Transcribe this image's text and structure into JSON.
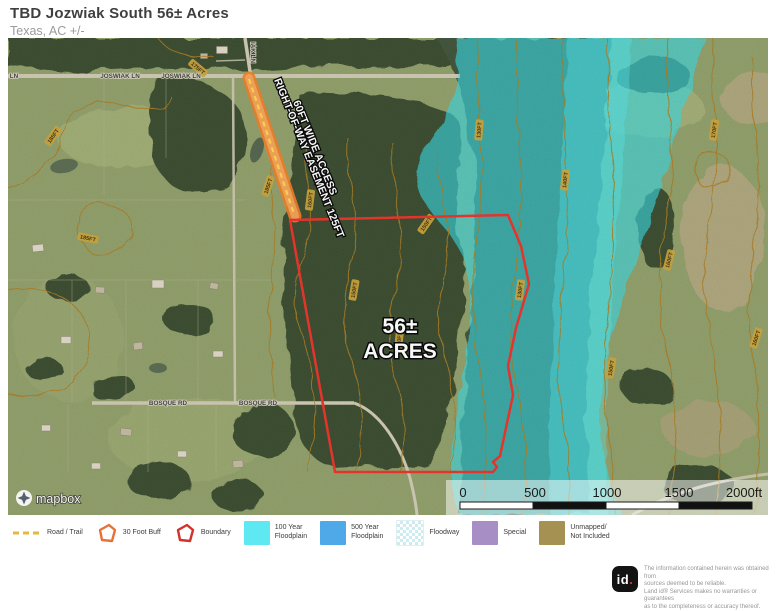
{
  "header": {
    "title": "TBD Jozwiak South 56± Acres",
    "subtitle": "Texas,  AC +/-"
  },
  "map": {
    "acres_line1": "56±",
    "acres_line2": "ACRES",
    "easement_line1": "60FT WIDE ACCESS",
    "easement_line2": "RIGHT-OF-WAY EASEMENT 125FT",
    "streets": {
      "joswiak1": "JOSWIAK LN",
      "joswiak2": "JOSWIAK LN",
      "ln_partial": "LN",
      "vertical": "IAK LN",
      "bosque1": "BOSQUE RD",
      "bosque2": "BOSQUE RD"
    },
    "contour_labels": [
      "185FT",
      "185FT",
      "175FT",
      "160FT",
      "150FT",
      "140FT",
      "150FT",
      "130FT",
      "130FT",
      "140FT",
      "150FT",
      "160FT",
      "170FT",
      "160FT",
      "185FT"
    ],
    "scale": {
      "t0": "0",
      "t500": "500",
      "t1000": "1000",
      "t1500": "1500",
      "t2000": "2000ft"
    },
    "attribution": "mapbox"
  },
  "legend": {
    "items": [
      {
        "label1": "Road / Trail",
        "label2": ""
      },
      {
        "label1": "30 Foot Buff",
        "label2": ""
      },
      {
        "label1": "Boundary",
        "label2": ""
      },
      {
        "label1": "100 Year",
        "label2": "Floodplain"
      },
      {
        "label1": "500 Year",
        "label2": "Floodplain"
      },
      {
        "label1": "Floodway",
        "label2": ""
      },
      {
        "label1": "Special",
        "label2": ""
      },
      {
        "label1": "Unmapped/",
        "label2": "Not Included"
      }
    ]
  },
  "colors": {
    "boundary": "#ea2d24",
    "buffer_30ft": "#e8713a",
    "road_trail": "#e6b83e",
    "floodplain_100yr": "#5ee9f2",
    "floodplain_500yr": "#4fa8e8",
    "floodway": "#cfeef0",
    "special": "#a78fc6",
    "unmapped": "#a59253",
    "contour": "#a9791b"
  },
  "footer": {
    "logo_text": "id",
    "logo_dot": ".",
    "line1": "The information contained herein was obtained from",
    "line2": "sources deemed to be reliable.",
    "line3": "Land id® Services makes no warranties or guarantees",
    "line4": "as to the completeness or accuracy thereof."
  }
}
